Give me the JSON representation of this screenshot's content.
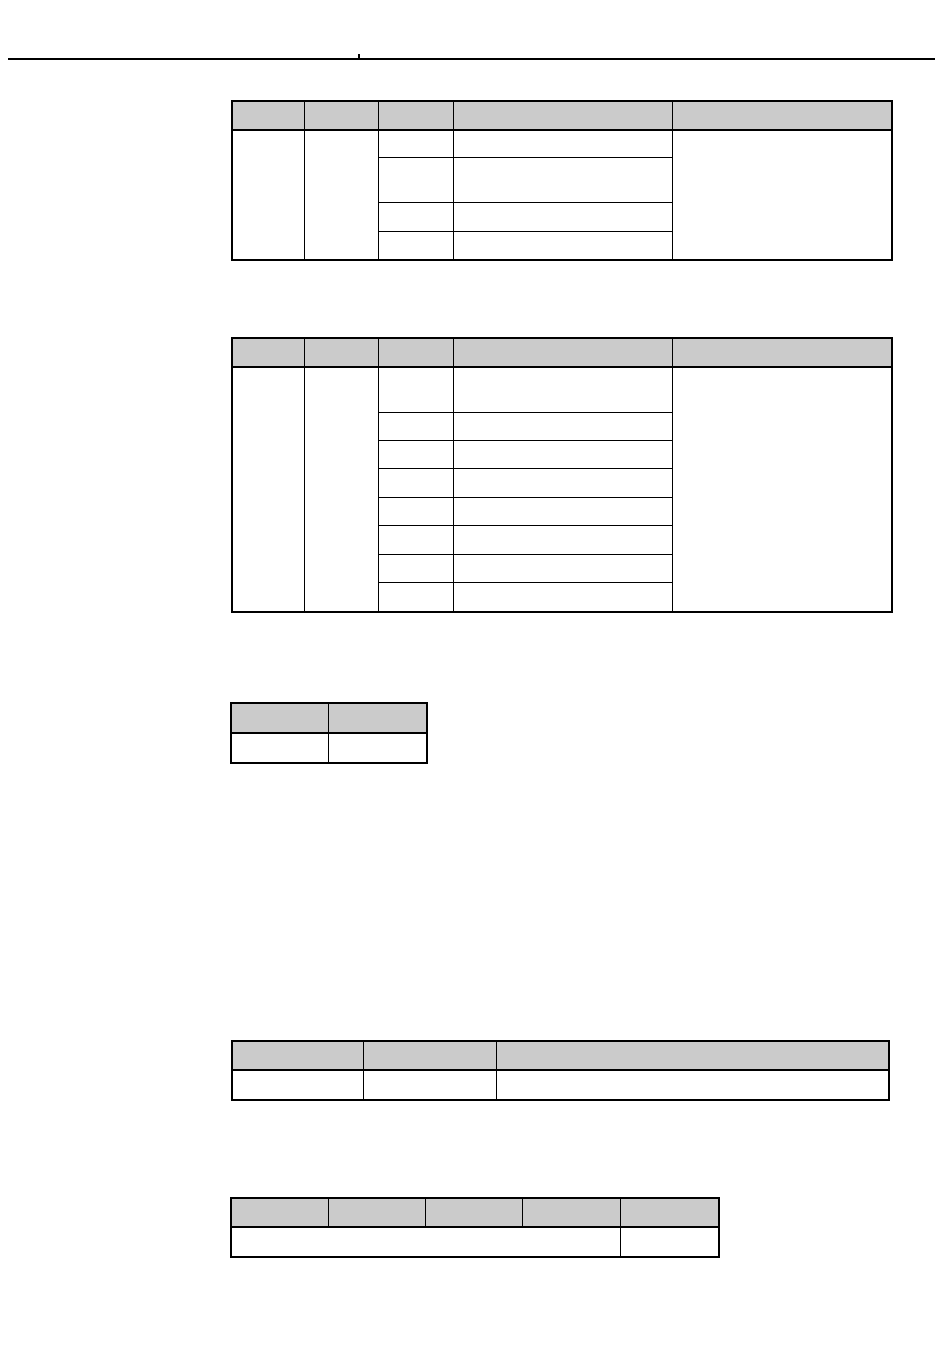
{
  "page": {
    "width": 950,
    "height": 1369,
    "background": "#ffffff",
    "line_color": "#000000",
    "table_header_fill": "#cbcbcb",
    "visible_text": ""
  },
  "header_rule": {
    "x": 8,
    "y": 58,
    "width": 927,
    "thickness": 2,
    "tick": {
      "x": 358,
      "y": 54,
      "width": 2,
      "height": 6
    }
  },
  "tables": [
    {
      "name": "parameter-table-1",
      "x": 231,
      "y": 100,
      "col_widths": [
        71,
        73,
        74,
        218,
        218
      ],
      "header_height": 27,
      "rows": [
        {
          "height": 26,
          "cells": [
            {
              "rowspan": 4
            },
            {
              "rowspan": 4
            },
            {},
            {},
            {
              "rowspan": 4
            }
          ]
        },
        {
          "height": 44,
          "cells": [
            {},
            {}
          ]
        },
        {
          "height": 28,
          "cells": [
            {},
            {}
          ]
        },
        {
          "height": 27,
          "cells": [
            {},
            {}
          ]
        }
      ]
    },
    {
      "name": "parameter-table-2",
      "x": 231,
      "y": 337,
      "col_widths": [
        71,
        73,
        74,
        218,
        218
      ],
      "header_height": 27,
      "rows": [
        {
          "height": 44,
          "cells": [
            {
              "rowspan": 8
            },
            {
              "rowspan": 8
            },
            {},
            {},
            {
              "rowspan": 8
            }
          ]
        },
        {
          "height": 27,
          "cells": [
            {},
            {}
          ]
        },
        {
          "height": 27,
          "cells": [
            {},
            {}
          ]
        },
        {
          "height": 28,
          "cells": [
            {},
            {}
          ]
        },
        {
          "height": 27,
          "cells": [
            {},
            {}
          ]
        },
        {
          "height": 28,
          "cells": [
            {},
            {}
          ]
        },
        {
          "height": 27,
          "cells": [
            {},
            {}
          ]
        },
        {
          "height": 28,
          "cells": [
            {},
            {}
          ]
        }
      ]
    },
    {
      "name": "small-table-2col",
      "x": 230,
      "y": 702,
      "col_widths": [
        96,
        97
      ],
      "header_height": 28,
      "rows": [
        {
          "height": 28,
          "cells": [
            {},
            {}
          ]
        }
      ]
    },
    {
      "name": "wide-table-3col",
      "x": 231,
      "y": 1040,
      "col_widths": [
        130,
        132,
        391
      ],
      "header_height": 27,
      "rows": [
        {
          "height": 28,
          "cells": [
            {},
            {},
            {}
          ]
        }
      ]
    },
    {
      "name": "bottom-table-5col",
      "x": 230,
      "y": 1197,
      "col_widths": [
        96,
        96,
        96,
        97,
        97
      ],
      "header_height": 27,
      "rows": [
        {
          "height": 28,
          "cells": [
            {
              "colspan": 4
            },
            {}
          ]
        }
      ]
    }
  ]
}
